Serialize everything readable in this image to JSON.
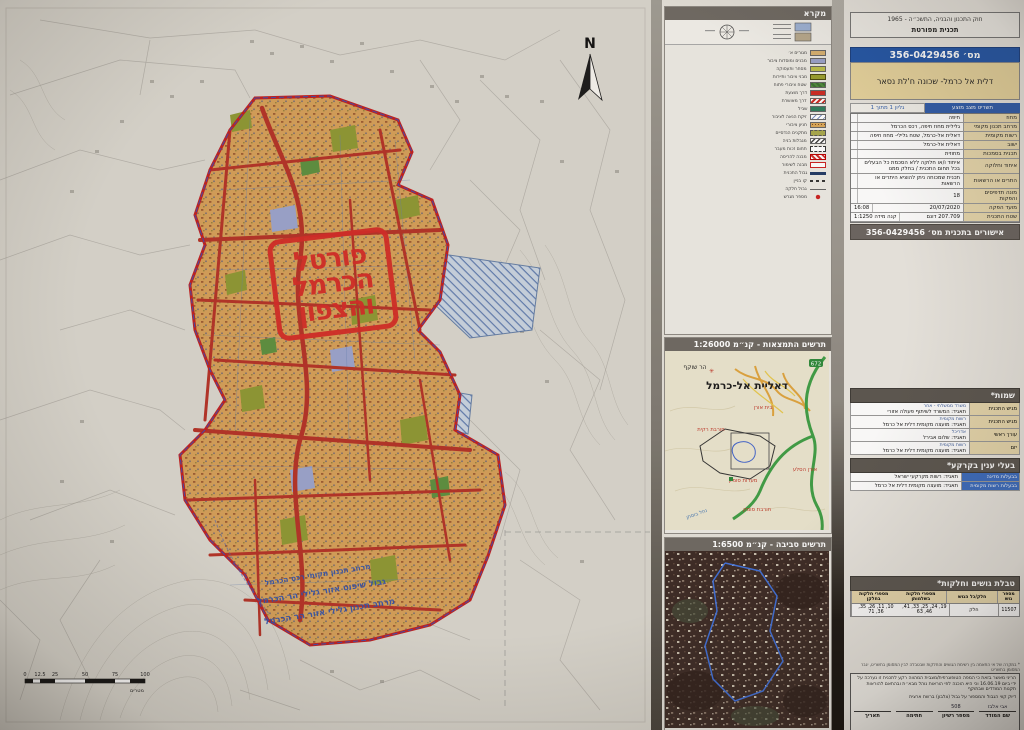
{
  "stamp": {
    "line1": "פורטל",
    "line2": "הכרמל",
    "line3": "והצפון"
  },
  "map": {
    "north": "N",
    "scale_ticks": [
      {
        "t": "0"
      },
      {
        "t": "12.5"
      },
      {
        "t": "25"
      },
      {
        "t": "50"
      },
      {
        "t": "75"
      },
      {
        "t": "100"
      }
    ],
    "scale_unit": "מטרים",
    "boundary_lines": [
      {
        "t": "מרחב תכנון מקומי רכס הכרמל"
      },
      {
        "t": "גבול שיפוט אזור גלילי הר הכרמל"
      },
      {
        "t": "מרחב תכנון גלילי אזור הר הכרמל"
      }
    ]
  },
  "legend": {
    "title": "מקרא",
    "items": [
      {
        "cls": "sw-tan",
        "label": "מגורים א׳"
      },
      {
        "cls": "sw-lav",
        "label": "מבנים ומוסדות ציבור"
      },
      {
        "cls": "sw-chart",
        "label": "מסחר ותעסוקה"
      },
      {
        "cls": "sw-olive",
        "label": "מבני ציבור ותיירות"
      },
      {
        "cls": "sw-green",
        "label": "שטח ציבורי פתוח"
      },
      {
        "cls": "sw-red",
        "label": "דרך מוצעת"
      },
      {
        "cls": "sw-redhatch",
        "label": "דרך מאושרת"
      },
      {
        "cls": "sw-teal",
        "label": "שביל"
      },
      {
        "cls": "sw-bluediag",
        "label": "זיקת הנאה לציבור"
      },
      {
        "cls": "sw-dots",
        "label": "חניון ציבורי"
      },
      {
        "cls": "sw-olivedash",
        "label": "מתקנים הנדסיים"
      },
      {
        "cls": "sw-blackhatch",
        "label": "מגבלות בניה"
      },
      {
        "cls": "sw-dashbox",
        "label": "תחום זכות מעבר"
      },
      {
        "cls": "sw-redhatch2",
        "label": "מבנה להריסה"
      },
      {
        "cls": "sw-redbox",
        "label": "מבנה לשימור"
      },
      {
        "cls": "ln-thick",
        "label": "גבול התכנית"
      },
      {
        "cls": "ln-dash",
        "label": "קו בניין"
      },
      {
        "cls": "ln-thin",
        "label": "גבול חלקה"
      },
      {
        "cls": "sym-reddot",
        "label": "מספר מגרש"
      }
    ]
  },
  "loc": {
    "title": "תרשים התמצאות - קנ״מ 1:26000",
    "town": "דאליית אל-כרמל",
    "mount": "הר שוקף",
    "site_top": "בית אורן",
    "site1": "חורבת רקית",
    "site2": "מערות סומק",
    "site3": "חורבת סומק",
    "site4": "אורן הסלע",
    "stream": "נחל בוסתן",
    "route": "672"
  },
  "env": {
    "title": "תרשים סביבה - קנ״מ 1:6500"
  },
  "tb": {
    "law": "חוק התכנון והבניה, התשכ״ה - 1965",
    "plan_type": "תכנית מפורטת",
    "num": "מס׳ 356-0429456",
    "name": "דלית אל כרמל- שכונה ח'לת נסאר",
    "sheet_right": "תשריט מצב מוצע",
    "sheet_left": "גליון 1 מתוך 1",
    "rows": [
      {
        "label": "מחוז",
        "value": "חיפה",
        "value2": ""
      },
      {
        "label": "מרחב תכנון מקומי",
        "value": "גלילית מחוז חיפה, רכס הכרמל",
        "value2": ""
      },
      {
        "label": "רשות מקומית",
        "value": "דאלית אל-כרמל, שטח גלילי- מחוז חיפה",
        "value2": ""
      },
      {
        "label": "ישוב",
        "value": "דאלית אל-כרמל",
        "value2": ""
      },
      {
        "label": "תכנית בסמכות",
        "value": "מחוזית",
        "value2": ""
      },
      {
        "label": "איחוד וחלוקה",
        "value": "איחוד ו/או חלוקה ללא הסכמת כל הבעלים בכל תחום התכנית / בחלק ממנו",
        "value2": ""
      },
      {
        "label": "התרים או הרשאות",
        "value": "תכנית שמכוחה ניתן להוציא היתרים או הרשאות",
        "value2": ""
      },
      {
        "label": "מונה תדפיסים והפקות",
        "value": "18",
        "value2": ""
      },
      {
        "label": "מועד הפקה",
        "value": "20/07/2020",
        "value2": "16:08"
      },
      {
        "label": "שטח התכנית",
        "value": "207.709 דונם",
        "value2": "קנה מידה 1:1250"
      }
    ],
    "approvals": "אישורים בתכנית מס׳ 356-0429456"
  },
  "names": {
    "title": "שמות*",
    "rows": [
      {
        "role": "מגיש התכנית",
        "line1": "משרד ממשלתי - אחר",
        "line2": "תאגיד: המשרד לשיתוף פעולה אזורי"
      },
      {
        "role": "מגיש התכנית",
        "line1": "רשות מקומית",
        "line2": "תאגיד: מועצה מקומית דלית אל כרמל"
      },
      {
        "role": "עורך ראשי",
        "line1": "אדריכל",
        "line2": "תאגיד: שלום אבירל"
      },
      {
        "role": "יזם",
        "line1": "רשות מקומית",
        "line2": "תאגיד: מועצה מקומית דלית אל כרמל"
      }
    ]
  },
  "owners": {
    "title": "בעלי ענין בקרקע*",
    "rows": [
      {
        "role": "בבעלות מדינה",
        "value": "תאגיד: רשות מקרקעי ישראל"
      },
      {
        "role": "בבעלות רשות מקומית",
        "value": "תאגיד: מועצה מקומית דלית אל כרמל"
      }
    ]
  },
  "parcels": {
    "title": "טבלת גושים וחלקות*",
    "headers": [
      {
        "t": "מספר גוש"
      },
      {
        "t": "חלק/כל הגוש"
      },
      {
        "t": "מספרי חלקות בשלמותן"
      },
      {
        "t": "מספרי חלקות בחלקן"
      }
    ],
    "row": [
      {
        "t": "11507"
      },
      {
        "t": "חלק"
      },
      {
        "t": "19, 24, 25, 33, 41, 46, 63"
      },
      {
        "t": "10, 11, 26, 35, 36, 71"
      }
    ]
  },
  "footer": {
    "note": "* במקרה של אי התאמה בין רשימת הגושים והחלקות שבטבלה לבין המסומן בתשריט, יגבר המסומן בתשריט",
    "cert": "הריני מאשר בזאת כי המפה הטופוגרפית/מצבית המהווה רקע לתכנית זו נערכה על ידי ביום 16.06.19 וכי היא הוכנה לפי הוראות נוהל מבא״ת ובהתאם להוראות תקנות המודדים שבתוקף",
    "precision": "דיוק קווי הגבול והמספור על גבול (צלבון) ברשת ארצית",
    "sig": [
      {
        "v": "אבי אלבז",
        "l": "שם המודד"
      },
      {
        "v": "508",
        "l": "מספר רשיון"
      },
      {
        "v": "",
        "l": "חתימה"
      },
      {
        "v": "",
        "l": "תאריך"
      }
    ],
    "produced": "הופק באמצעות מערכת מבא״ת מקוונת"
  }
}
